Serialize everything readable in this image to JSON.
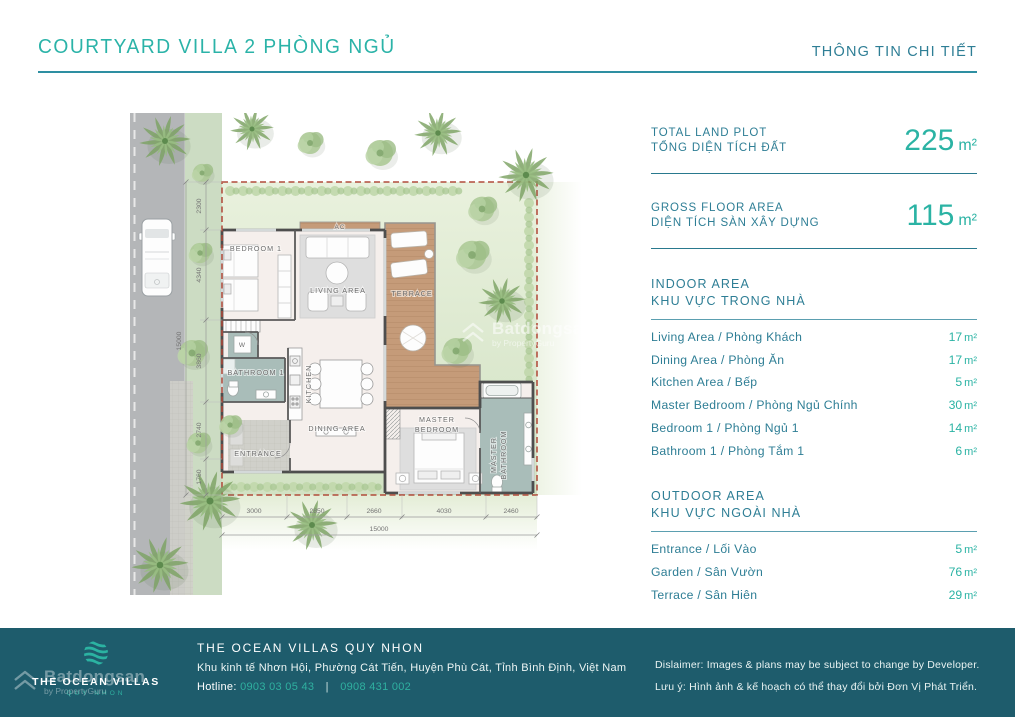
{
  "header": {
    "title": "COURTYARD VILLA 2 PHÒNG NGỦ",
    "subtitle": "THÔNG TIN CHI TIẾT"
  },
  "colors": {
    "accent_teal": "#2bb3a4",
    "label_blue": "#2e7e95",
    "footer_bg": "#1e5c6c",
    "plot_border_red": "#b04a3a",
    "terrace_wood": "#c59b79",
    "wet_room_floor": "#a9bdb9"
  },
  "panel": {
    "stats": [
      {
        "label_en": "TOTAL LAND PLOT",
        "label_vi": "TỔNG DIỆN TÍCH ĐẤT",
        "value": "225",
        "unit": "m²"
      },
      {
        "label_en": "GROSS FLOOR AREA",
        "label_vi": "DIỆN TÍCH SÀN XÂY DỰNG",
        "value": "115",
        "unit": "m²"
      }
    ],
    "indoor": {
      "title_en": "INDOOR AREA",
      "title_vi": "KHU VỰC TRONG NHÀ",
      "rows": [
        {
          "label": "Living Area / Phòng Khách",
          "value": "17",
          "unit": "m²"
        },
        {
          "label": "Dining Area / Phòng Ăn",
          "value": "17",
          "unit": "m²"
        },
        {
          "label": "Kitchen Area / Bếp",
          "value": "5",
          "unit": "m²"
        },
        {
          "label": "Master Bedroom / Phòng Ngủ Chính",
          "value": "30",
          "unit": "m²"
        },
        {
          "label": "Bedroom 1 / Phòng Ngủ 1",
          "value": "14",
          "unit": "m²"
        },
        {
          "label": "Bathroom 1 / Phòng Tắm 1",
          "value": "6",
          "unit": "m²"
        }
      ]
    },
    "outdoor": {
      "title_en": "OUTDOOR AREA",
      "title_vi": "KHU VỰC NGOÀI NHÀ",
      "rows": [
        {
          "label": "Entrance / Lối Vào",
          "value": "5",
          "unit": "m²"
        },
        {
          "label": "Garden / Sân Vườn",
          "value": "76",
          "unit": "m²"
        },
        {
          "label": "Terrace / Sân Hiên",
          "value": "29",
          "unit": "m²"
        }
      ]
    }
  },
  "plan": {
    "rooms": {
      "bedroom1": "BEDROOM 1",
      "living": "LIVING AREA",
      "terrace": "TERRACE",
      "ac": "AC",
      "washer": "W",
      "bathroom1": "BATHROOM 1",
      "kitchen": "KITCHEN",
      "dining": "DINING AREA",
      "entrance": "ENTRANCE",
      "master_bedroom": [
        "MASTER",
        "BEDROOM"
      ],
      "master_bathroom": [
        "MASTER",
        "BATHROOM"
      ]
    },
    "dims": {
      "left": [
        "2300",
        "4340",
        "3860",
        "2740",
        "1760"
      ],
      "bottom": [
        "3000",
        "2850",
        "2660",
        "4030",
        "2460"
      ],
      "total_vertical": "15000",
      "total_horizontal": "15000"
    }
  },
  "watermark": {
    "brand": "Batdongsan",
    "byline": "by PropertyGuru"
  },
  "footer": {
    "logo": {
      "line1": "THE OCEAN VILLAS",
      "line2": "QUY NHON"
    },
    "company": "THE OCEAN VILLAS QUY NHON",
    "address": "Khu kinh tế Nhơn Hội, Phường Cát Tiến, Huyện Phù Cát, Tỉnh Bình Định, Việt Nam",
    "hotline_label": "Hotline:",
    "phone1": "0903 03 05 43",
    "separator": "|",
    "phone2": "0908 431 002",
    "disclaimer_en": "Dislaimer: Images & plans may be subject to change by Developer.",
    "disclaimer_vi": "Lưu ý: Hình ảnh & kế hoạch có thể thay đổi bởi Đơn Vị Phát Triển."
  }
}
